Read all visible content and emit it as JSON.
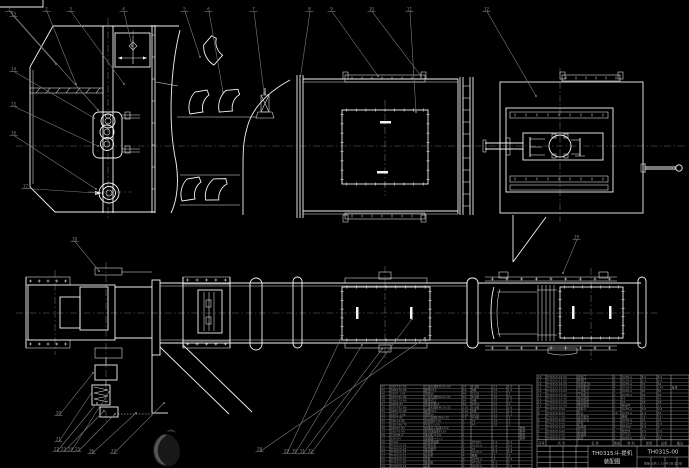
{
  "sheet": {
    "background": "#000000",
    "line_color": "#f5f5f5",
    "annotation_color": "#7d7d7d",
    "table_text_color": "#8f8f8f"
  },
  "title_block": {
    "product_title": "TH0315斗-提机",
    "sheet_type": "装配图",
    "drawing_number": "TH0315-00",
    "number_subrow": "质量  比例 1:10  共1张 第1张"
  },
  "bom_right": {
    "header": [
      "序号",
      "代  号",
      "名  称",
      "数量",
      "材  料",
      "单重",
      "总重",
      "备注"
    ],
    "rows": [
      [
        "18",
        "TH0315-18-00",
        "出料口",
        "1",
        "Q235-A",
        "8.5",
        "8.5",
        ""
      ],
      [
        "17",
        "TH0315-17-00",
        "检视门",
        "2",
        "Q235-A",
        "3.2",
        "6.4",
        ""
      ],
      [
        "16",
        "TH0315-16-00",
        "中部机壳Ⅱ",
        "2",
        "Q235-A",
        "32",
        "64",
        ""
      ],
      [
        "15",
        "TH0315-15-00",
        "中部机壳Ⅰ",
        "4",
        "Q235-A",
        "36",
        "144",
        "备用"
      ],
      [
        "14",
        "TH0315-14-00",
        "上部机壳",
        "1",
        "Q235-A",
        "85",
        "85",
        ""
      ],
      [
        "13",
        "TH0315-13-00",
        "下部机壳",
        "1",
        "Q235-A",
        "96",
        "96",
        ""
      ],
      [
        "12",
        "TH0315-12-00",
        "传动滚筒",
        "1",
        "45",
        "42",
        "42",
        ""
      ],
      [
        "11",
        "TH0315-11-00",
        "改向滚筒",
        "1",
        "45",
        "38",
        "38",
        ""
      ],
      [
        "10",
        "TH0315-10-00",
        "张紧装置",
        "1",
        "组合件",
        "12",
        "12",
        ""
      ],
      [
        "9",
        "TH0315-9-00",
        "进料斗",
        "1",
        "Q235-A",
        "9.6",
        "9.6",
        ""
      ],
      [
        "8",
        "TH0315-8-00",
        "料斗",
        "46",
        "Q235-A",
        "1.2",
        "55",
        ""
      ],
      [
        "7",
        "TH0315-7-00",
        "牵引胶带",
        "1",
        "橡胶",
        "28",
        "28",
        ""
      ],
      [
        "6",
        "TH0315-6-00",
        "驱动平台",
        "1",
        "Q235-A",
        "22",
        "22",
        ""
      ],
      [
        "5",
        "TH0315-5-00",
        "护罩",
        "1",
        "Q235-A",
        "6.8",
        "6.8",
        ""
      ],
      [
        "4",
        "TH0315-4-00",
        "轴承座",
        "2",
        "HT200",
        "4.5",
        "9",
        ""
      ],
      [
        "3",
        "TH0315-3-00",
        "逆止器",
        "1",
        "组合件",
        "3.5",
        "3.5",
        ""
      ],
      [
        "2",
        "TH0315-2-00",
        "联轴器",
        "1",
        "HT200",
        "5.2",
        "5.2",
        ""
      ],
      [
        "1",
        "TH0315-1-00",
        "机架",
        "1",
        "Q235-A",
        "18",
        "18",
        ""
      ]
    ]
  },
  "bom_left": {
    "rows": [
      [
        "42",
        "GB5782-86",
        "六角头螺栓M16×60",
        "24",
        "8.8级",
        ".11",
        "2.6",
        ""
      ],
      [
        "41",
        "GB6170-86",
        "螺母M16",
        "48",
        "8级",
        ".03",
        "1.4",
        ""
      ],
      [
        "40",
        "GB97.1-85",
        "垫圈16",
        "48",
        "Q235",
        ".01",
        ".5",
        ""
      ],
      [
        "39",
        "GB5782-86",
        "六角头螺栓M12×45",
        "60",
        "8.8级",
        ".05",
        "3.0",
        ""
      ],
      [
        "38",
        "GB6170-86",
        "螺母M12",
        "60",
        "8级",
        ".02",
        "1.2",
        ""
      ],
      [
        "37",
        "GB93-87",
        "弹簧垫圈12",
        "60",
        "65Mn",
        ".01",
        ".6",
        ""
      ],
      [
        "36",
        "GB5782-86",
        "六角头螺栓M10×35",
        "120",
        "8.8级",
        ".03",
        "3.6",
        ""
      ],
      [
        "35",
        "GB6170-86",
        "螺母M10",
        "120",
        "8级",
        ".01",
        "1.2",
        ""
      ],
      [
        "34",
        "GB97.1-85",
        "垫圈10",
        "120",
        "Q235",
        ".01",
        "1.2",
        ""
      ],
      [
        "33",
        "GB70-85",
        "内六角螺钉M8×25",
        "16",
        "8.8级",
        ".02",
        ".3",
        ""
      ],
      [
        "32",
        "GB119-86",
        "圆柱销8×30",
        "4",
        "45",
        ".02",
        ".1",
        ""
      ],
      [
        "31",
        "GB1096-79",
        "平键12×56",
        "2",
        "45",
        ".05",
        ".1",
        ""
      ],
      [
        "30",
        "GB297-84",
        "圆锥滚子轴承7312",
        "2",
        "",
        "",
        "",
        "购件"
      ],
      [
        "29",
        "GB276-89",
        "深沟球轴承6310",
        "2",
        "",
        "",
        "",
        "购件"
      ],
      [
        "28",
        "Y160M-4",
        "电动机11kW",
        "1",
        "",
        "",
        "",
        "购件"
      ],
      [
        "27",
        "ZQ40-Ⅱ",
        "减速器i=31.5",
        "1",
        "",
        "",
        "",
        "购件"
      ],
      [
        "26",
        "TGL6",
        "弹性联轴器",
        "1",
        "HT200",
        "5.2",
        "5.2",
        ""
      ],
      [
        "25",
        "TH0315-25",
        "护罩支架",
        "2",
        "Q235-A",
        "1.8",
        "3.6",
        ""
      ],
      [
        "24",
        "TH0315-24",
        "张紧螺杆",
        "2",
        "45",
        "2.1",
        "4.2",
        ""
      ],
      [
        "23",
        "TH0315-23",
        "导料板",
        "2",
        "Q235-A",
        "2.4",
        "4.8",
        ""
      ],
      [
        "22",
        "TH0315-22",
        "密封垫",
        "4",
        "橡胶",
        ".2",
        ".8",
        ""
      ],
      [
        "21",
        "TH0315-21",
        "压板",
        "8",
        "Q235-A",
        ".3",
        "2.4",
        ""
      ],
      [
        "20",
        "TH0315-20",
        "轴承座",
        "2",
        "HT200",
        "4.5",
        "9",
        ""
      ],
      [
        "19",
        "TH0315-19",
        "盖板",
        "2",
        "Q235-A",
        "1.6",
        "3.2",
        ""
      ]
    ]
  },
  "callouts": [
    {
      "n": "1",
      "x": 8,
      "y": 7,
      "tx": 98,
      "ty": 110
    },
    {
      "n": "2",
      "x": 45,
      "y": 7,
      "tx": 76,
      "ty": 84
    },
    {
      "n": "3",
      "x": 69,
      "y": 7,
      "tx": 124,
      "ty": 84
    },
    {
      "n": "4",
      "x": 122,
      "y": 7,
      "tx": 132,
      "ty": 46
    },
    {
      "n": "5",
      "x": 183,
      "y": 7,
      "tx": 200,
      "ty": 57
    },
    {
      "n": "6",
      "x": 207,
      "y": 7,
      "tx": 223,
      "ty": 92
    },
    {
      "n": "7",
      "x": 252,
      "y": 7,
      "tx": 264,
      "ty": 93
    },
    {
      "n": "8",
      "x": 308,
      "y": 7,
      "tx": 300,
      "ty": 80
    },
    {
      "n": "9",
      "x": 330,
      "y": 7,
      "tx": 378,
      "ty": 76
    },
    {
      "n": "10",
      "x": 370,
      "y": 7,
      "tx": 421,
      "ty": 76
    },
    {
      "n": "11",
      "x": 408,
      "y": 7,
      "tx": 416,
      "ty": 112
    },
    {
      "n": "12",
      "x": 485,
      "y": 7,
      "tx": 536,
      "ty": 96
    },
    {
      "n": "13",
      "x": 12,
      "y": 12,
      "tx": 56,
      "ty": 64
    },
    {
      "n": "14",
      "x": 12,
      "y": 67,
      "tx": 94,
      "ty": 118
    },
    {
      "n": "15",
      "x": 12,
      "y": 102,
      "tx": 98,
      "ty": 146
    },
    {
      "n": "16",
      "x": 12,
      "y": 131,
      "tx": 96,
      "ty": 189
    },
    {
      "n": "17",
      "x": 24,
      "y": 184,
      "tx": 96,
      "ty": 193
    },
    {
      "n": "18",
      "x": 73,
      "y": 237,
      "tx": 99,
      "ty": 271
    },
    {
      "n": "19",
      "x": 575,
      "y": 235,
      "tx": 563,
      "ty": 273
    },
    {
      "n": "20",
      "x": 57,
      "y": 411,
      "tx": 93,
      "ty": 373
    },
    {
      "n": "21",
      "x": 57,
      "y": 437,
      "tx": 92,
      "ty": 392
    },
    {
      "n": "22",
      "x": 55,
      "y": 447,
      "tx": 97,
      "ty": 403
    },
    {
      "n": "23",
      "x": 62,
      "y": 447,
      "tx": 104,
      "ty": 411
    },
    {
      "n": "24",
      "x": 69,
      "y": 447,
      "tx": 109,
      "ty": 392
    },
    {
      "n": "25",
      "x": 76,
      "y": 447,
      "tx": 115,
      "ty": 414
    },
    {
      "n": "26",
      "x": 90,
      "y": 449,
      "tx": 136,
      "ty": 413
    },
    {
      "n": "27",
      "x": 112,
      "y": 449,
      "tx": 164,
      "ty": 403
    },
    {
      "n": "28",
      "x": 258,
      "y": 447,
      "tx": 425,
      "ty": 338
    },
    {
      "n": "29",
      "x": 285,
      "y": 449,
      "tx": 342,
      "ty": 336
    },
    {
      "n": "30",
      "x": 293,
      "y": 449,
      "tx": 362,
      "ty": 345
    },
    {
      "n": "31",
      "x": 301,
      "y": 449,
      "tx": 382,
      "ty": 349
    },
    {
      "n": "32",
      "x": 309,
      "y": 449,
      "tx": 412,
      "ty": 319
    }
  ]
}
